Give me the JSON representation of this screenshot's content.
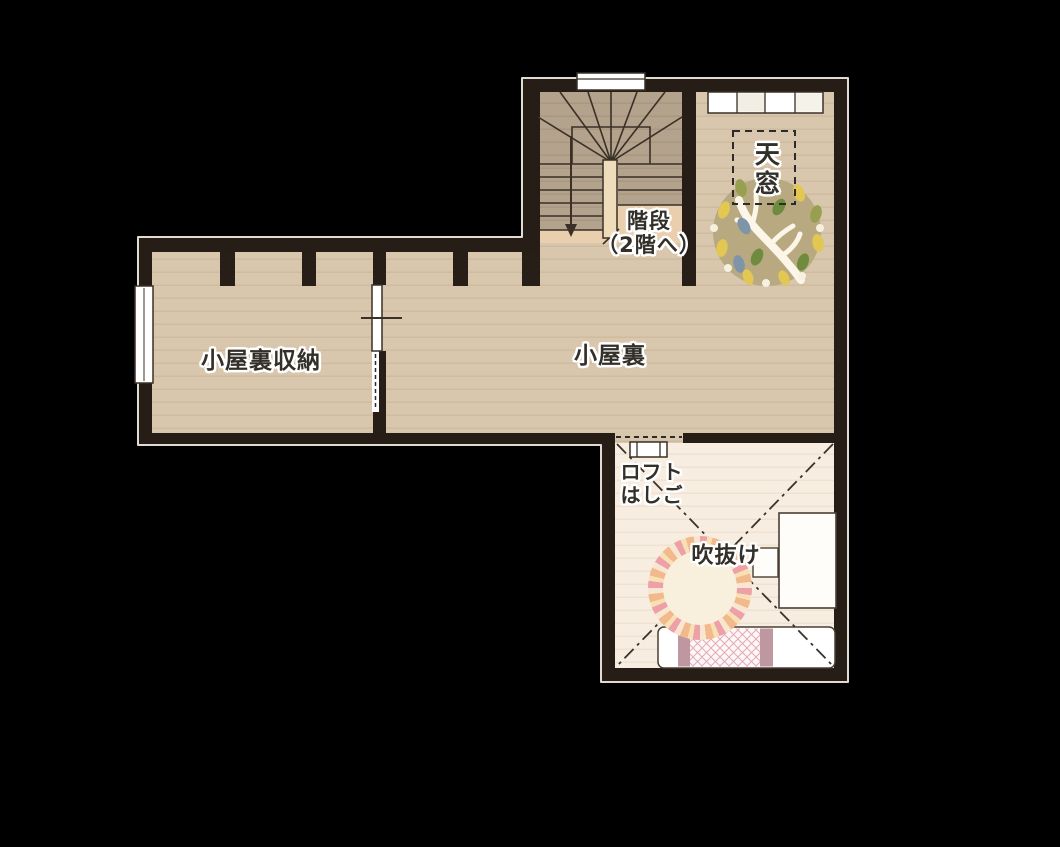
{
  "plan": {
    "type": "floor-plan",
    "floor": "attic",
    "rooms": {
      "attic_storage": {
        "label": "小屋裏収納"
      },
      "attic": {
        "label": "小屋裏"
      },
      "stairs": {
        "label_line1": "階段",
        "label_line2": "（2階へ）"
      },
      "skylight": {
        "label": "天窓"
      },
      "loft_ladder": {
        "label_line1": "ロフト",
        "label_line2": "はしご"
      },
      "void": {
        "label": "吹抜け"
      }
    },
    "colors": {
      "background": "#000000",
      "wall": "#281e18",
      "outer_outline": "#e8e4da",
      "floor_main": "#d8c6ad",
      "floor_stairs": "#b3a28c",
      "stair_landing": "#e9cfad",
      "floor_void": "#f7eee1",
      "line": "#3a3026",
      "rug_tree_base": "#b8a981",
      "rug_stripe_pink": "#eda0a8",
      "bed_accent": "#bf97a1"
    },
    "furniture_icons": [
      "winder-staircase",
      "down-arrow",
      "skylight-dashed-outline",
      "tree-rug",
      "shelf-unit",
      "top-window",
      "side-window",
      "sliding-door",
      "loft-ladder",
      "round-striped-rug",
      "desk",
      "chair",
      "bed",
      "void-diagonal-marks"
    ]
  }
}
